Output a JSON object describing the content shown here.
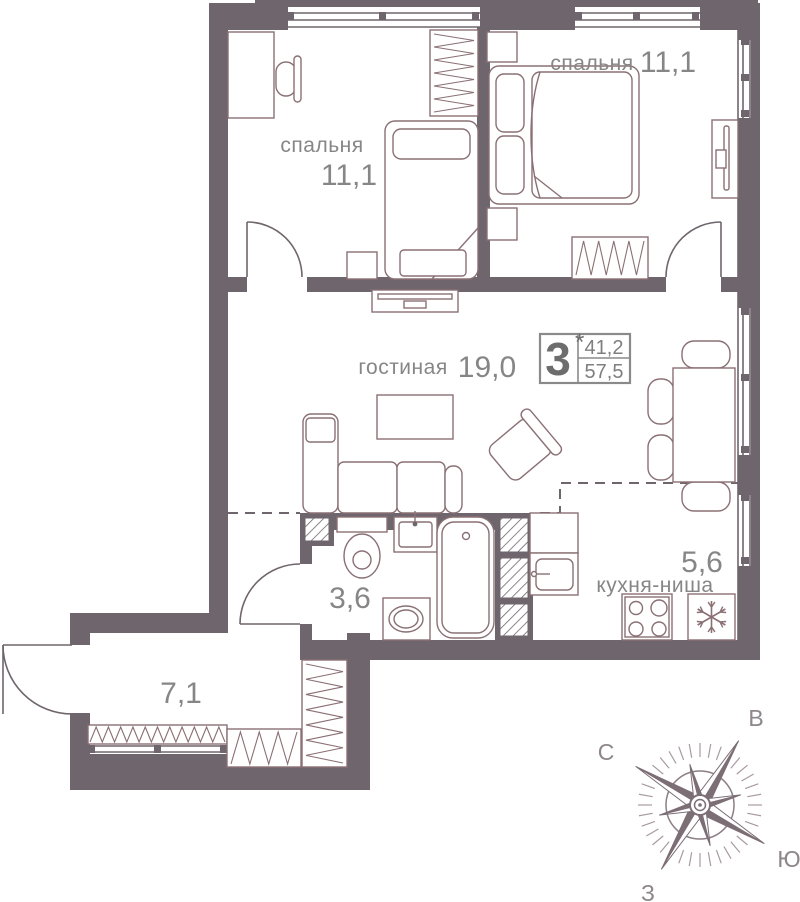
{
  "plan": {
    "rooms": {
      "bedroom_left": {
        "name": "спальня",
        "area": "11,1"
      },
      "bedroom_right": {
        "name": "спальня",
        "area": "11,1"
      },
      "living": {
        "name": "гостиная",
        "area": "19,0"
      },
      "bathroom": {
        "area": "3,6"
      },
      "kitchen": {
        "name": "кухня-ниша",
        "area": "5,6"
      },
      "hall": {
        "area": "7,1"
      }
    },
    "badge": {
      "rooms_count": "3",
      "star": "*",
      "area_living": "41,2",
      "area_total": "57,5"
    },
    "compass": {
      "north": "С",
      "south": "Ю",
      "east": "В",
      "west": "З"
    },
    "colors": {
      "wall": "#6f656c",
      "furniture_line": "#8a7074",
      "text": "#868686",
      "compass_dark": "#7c6e75"
    }
  }
}
